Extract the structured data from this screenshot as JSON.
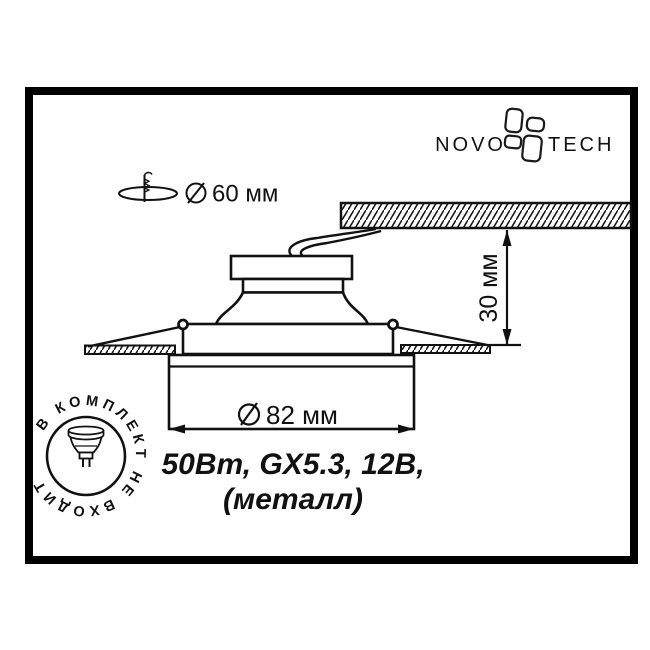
{
  "brand": {
    "name_left": "NOVO",
    "name_right": "TECH",
    "icon": "pinwheel-icon"
  },
  "annotations": {
    "cutout": {
      "icon": "diameter-circle-slash-icon",
      "value": "60 мм",
      "marker_icon": "drill-hole-icon"
    },
    "trim_diameter": {
      "icon": "diameter-circle-slash-icon",
      "value": "82 мм"
    },
    "recess_depth": {
      "value": "30 мм"
    }
  },
  "specs": {
    "line1": "50Вт, GX5.3, 12В,",
    "line2": "(металл)"
  },
  "badge": {
    "text": "В КОМПЛЕКТ НЕ ВХОДИТ",
    "icon": "mr16-lamp-icon"
  },
  "colors": {
    "line": "#111111",
    "background": "#ffffff"
  }
}
